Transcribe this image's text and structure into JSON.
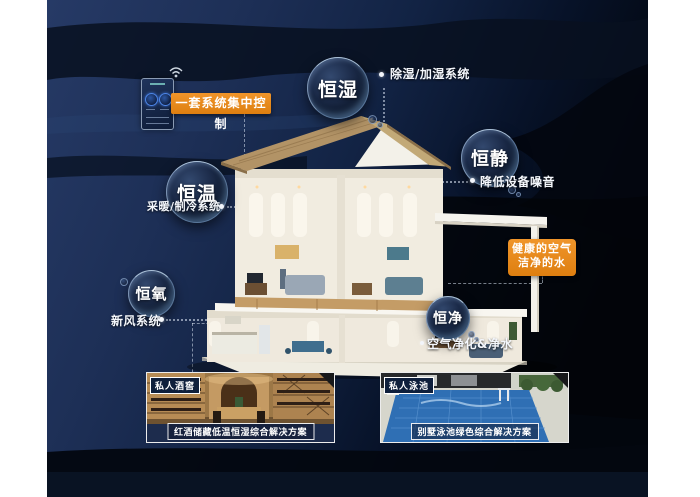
{
  "colors": {
    "accent_orange": "#E8891C",
    "background_navy": "#1D2F56",
    "background_black": "#04080F",
    "bubble_rim_blue": "#9FC4EE",
    "caption_band_navy": "#1D2C4D",
    "pool_water_blue": "#2F6FB4",
    "cellar_wood_brown": "#9C7746",
    "roof_tan": "#B39768"
  },
  "control_panel": {
    "label": "一套系统集中控制"
  },
  "bubbles": {
    "humidity": {
      "label": "恒湿",
      "caption": "除湿/加湿系统"
    },
    "quiet": {
      "label": "恒静",
      "caption": "降低设备噪音"
    },
    "temperature": {
      "label": "恒温",
      "caption": "采暖/制冷系统"
    },
    "oxygen": {
      "label": "恒氧",
      "caption": "新风系统"
    },
    "purity": {
      "label": "恒净",
      "caption": "空气净化&净水"
    }
  },
  "highlight_box": {
    "line1": "健康的空气",
    "line2": "洁净的水"
  },
  "photo_cards": {
    "wine_cellar": {
      "tag": "私人酒窖",
      "caption": "红酒储藏低温恒湿综合解决方案"
    },
    "pool": {
      "tag": "私人泳池",
      "caption": "别墅泳池绿色综合解决方案"
    }
  }
}
